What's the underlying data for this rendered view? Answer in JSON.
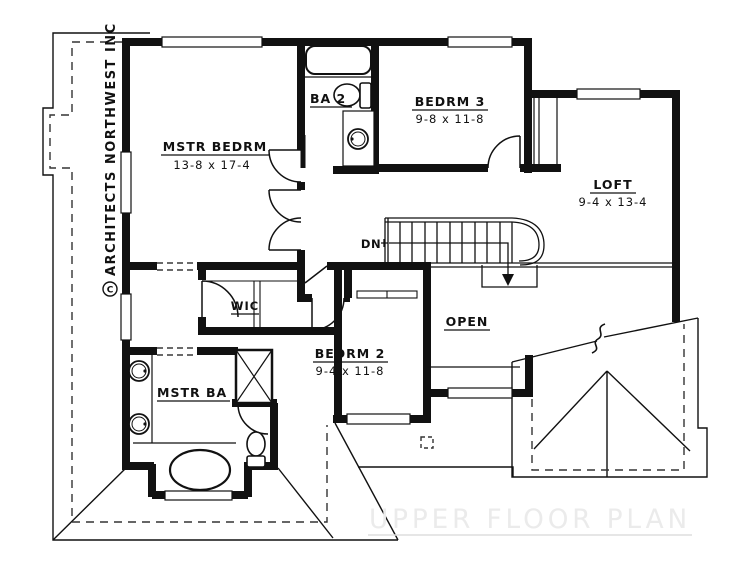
{
  "title": {
    "text": "UPPER FLOOR PLAN"
  },
  "watermark": {
    "text": "ARCHITECTS NORTHWEST INC",
    "symbol": "C"
  },
  "rooms": {
    "mstr_bedrm": {
      "label": "MSTR BEDRM",
      "dims": "13-8 x 17-4"
    },
    "ba2": {
      "label": "BA 2"
    },
    "bedrm3": {
      "label": "BEDRM 3",
      "dims": "9-8 x 11-8"
    },
    "loft": {
      "label": "LOFT",
      "dims": "9-4 x 13-4"
    },
    "wic": {
      "label": "WIC"
    },
    "mstr_ba": {
      "label": "MSTR BA"
    },
    "bedrm2": {
      "label": "BEDRM 2",
      "dims": "9-4 x 11-8"
    },
    "open": {
      "label": "OPEN"
    },
    "stairs": {
      "label": "DN"
    }
  },
  "colors": {
    "ink": "#111111",
    "paper": "#ffffff",
    "title_gray": "#ebebeb"
  }
}
